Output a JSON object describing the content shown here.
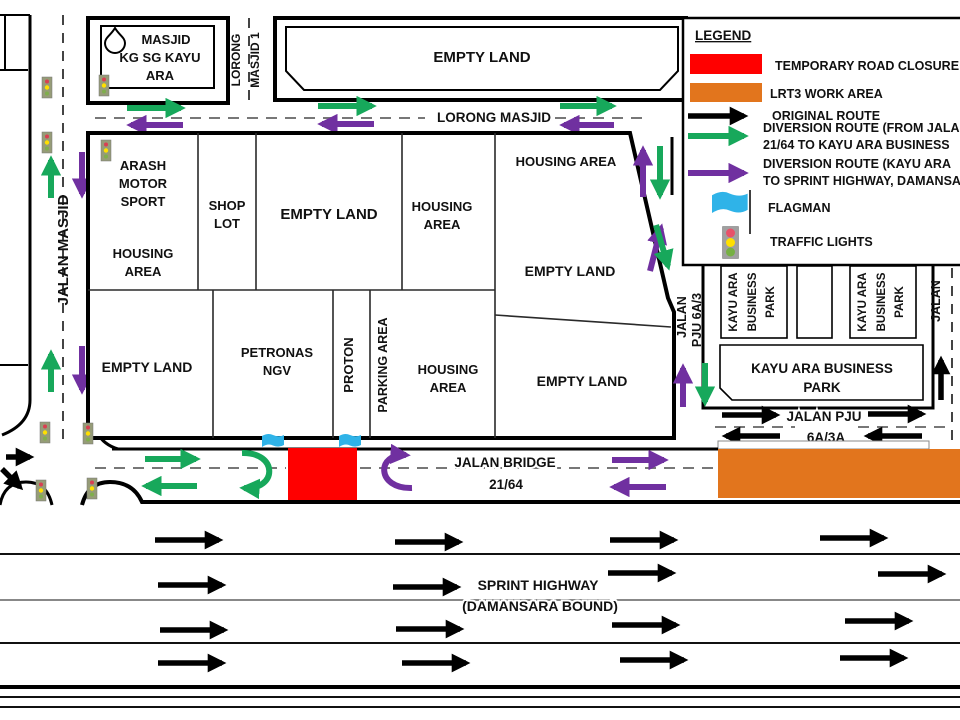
{
  "legend": {
    "title": "LEGEND",
    "items": [
      {
        "icon": "red-swatch",
        "label": "TEMPORARY ROAD CLOSURE"
      },
      {
        "icon": "orange-swatch",
        "label": "LRT3 WORK AREA"
      },
      {
        "icon": "black-arrow",
        "label": "ORIGINAL ROUTE"
      },
      {
        "icon": "green-arrow",
        "label": "DIVERSION ROUTE (FROM JALAN",
        "label2": "21/64 TO KAYU ARA BUSINESS"
      },
      {
        "icon": "purple-arrow",
        "label": "DIVERSION ROUTE (KAYU ARA",
        "label2": "TO SPRINT HIGHWAY, DAMANSA"
      },
      {
        "icon": "flagman-flag",
        "label": "FLAGMAN"
      },
      {
        "icon": "traffic-light",
        "label": "TRAFFIC LIGHTS"
      }
    ]
  },
  "roads": {
    "jalan_masjid": "JALAN MASJID",
    "lorong_masjid_1_a": "LORONG",
    "lorong_masjid_1_b": "MASJID 1",
    "lorong_masjid": "LORONG MASJID",
    "jalan_bridge_a": "JALAN BRIDGE",
    "jalan_bridge_b": "21/64",
    "sprint_a": "SPRINT HIGHWAY",
    "sprint_b": "(DAMANSARA BOUND)",
    "pju6a3_a": "JALAN",
    "pju6a3_b": "PJU 6A/3",
    "pju6a3a_a": "JALAN PJU",
    "pju6a3a_b": "6A/3A",
    "jalan_right": "JALAN"
  },
  "areas": {
    "masjid": [
      "MASJID",
      "KG SG KAYU",
      "ARA"
    ],
    "empty_land_top": "EMPTY LAND",
    "arash": [
      "ARASH",
      "MOTOR",
      "SPORT"
    ],
    "arash_housing": [
      "HOUSING",
      "AREA"
    ],
    "shop_lot": [
      "SHOP",
      "LOT"
    ],
    "empty_land_mid": "EMPTY LAND",
    "housing_mid": [
      "HOUSING",
      "AREA"
    ],
    "housing_topright": "HOUSING AREA",
    "empty_land_right": "EMPTY LAND",
    "empty_land_bottomleft": "EMPTY LAND",
    "petronas": [
      "PETRONAS",
      "NGV"
    ],
    "proton": "PROTON",
    "parking": "PARKING AREA",
    "housing_bottom": [
      "HOUSING",
      "AREA"
    ],
    "empty_land_bottomright": "EMPTY LAND",
    "kayu_small": [
      "KAYU ARA",
      "BUSINESS",
      "PARK"
    ],
    "kayu_big": [
      "KAYU ARA BUSINESS",
      "PARK"
    ]
  },
  "colors": {
    "closure_red": "#FF0000",
    "lrt3_orange": "#E2751D",
    "diversion_green": "#17A85B",
    "diversion_purple": "#7030A0",
    "flag_blue": "#2FB3E8",
    "route_black": "#000000"
  }
}
